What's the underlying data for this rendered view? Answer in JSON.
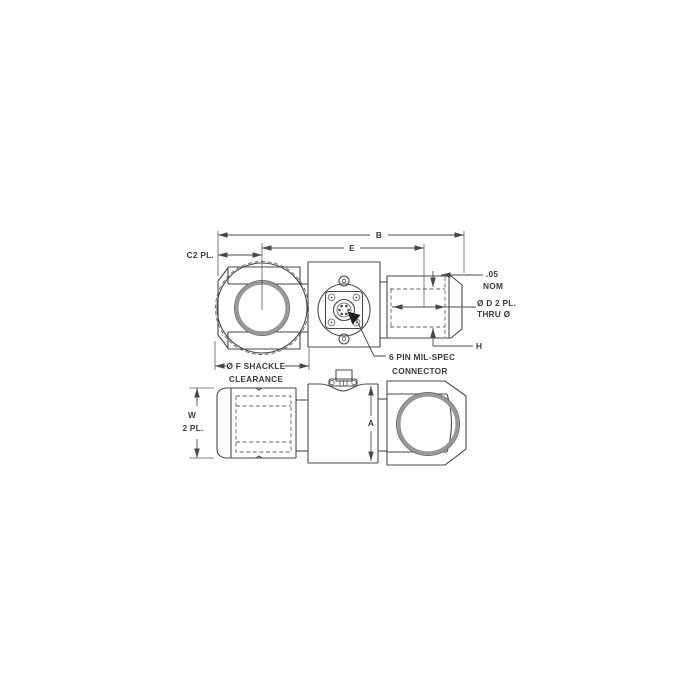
{
  "labels": {
    "dim_b": "B",
    "dim_e": "E",
    "dim_c2": "C2 PL.",
    "shackle_line1": "Ø F SHACKLE",
    "shackle_line2": "CLEARANCE",
    "connector_line1": "6 PIN MIL-SPEC",
    "connector_line2": "CONNECTOR",
    "nom_value": ".05",
    "nom_label": "NOM",
    "dia_d": "Ø D 2 PL.",
    "thru_d": "THRU Ø",
    "dim_h": "H",
    "dim_w": "W",
    "dim_w_places": "2 PL.",
    "dim_a": "A"
  },
  "icons": {
    "connector_pointer": "filled-triangle-pointer-arrow"
  },
  "colors": {
    "line": "#4a4a4a",
    "hole_ring": "#989898",
    "text": "#3b3b3b",
    "background": "#ffffff"
  }
}
